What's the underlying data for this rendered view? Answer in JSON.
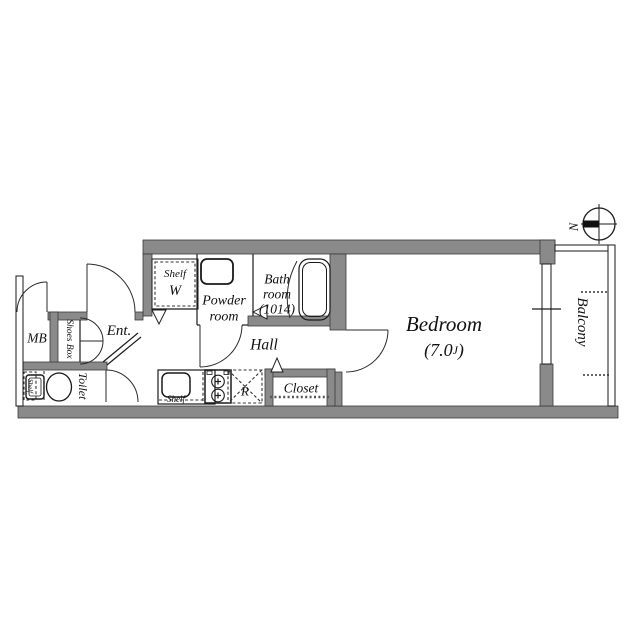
{
  "floor_plan": {
    "compass": {
      "north_label": "N"
    },
    "bedroom": {
      "name": "Bedroom",
      "size_open": "(7.0",
      "size_unit": "J",
      "size_close": ")"
    },
    "balcony": {
      "name": "Balcony"
    },
    "hall": {
      "name": "Hall"
    },
    "powder_room": {
      "line1": "Powder",
      "line2": "room"
    },
    "bath_room": {
      "line1": "Bath",
      "line2": "room",
      "line3": "(1014)"
    },
    "toilet": {
      "name": "Toilet",
      "shelf_label": "Shelf"
    },
    "entrance": {
      "name": "Ent."
    },
    "shoes_box": {
      "name": "Shoes Box"
    },
    "meter_box": {
      "name": "MB"
    },
    "closet": {
      "name": "Closet"
    },
    "laundry_nook": {
      "shelf_label": "Shelf",
      "washer_label": "W"
    },
    "kitchen": {
      "shelf_label": "Shelf",
      "refrigerator_label": "R"
    },
    "colors": {
      "wall_fill": "#8a8a8a",
      "line": "#1a1a1a",
      "background": "#ffffff"
    }
  }
}
